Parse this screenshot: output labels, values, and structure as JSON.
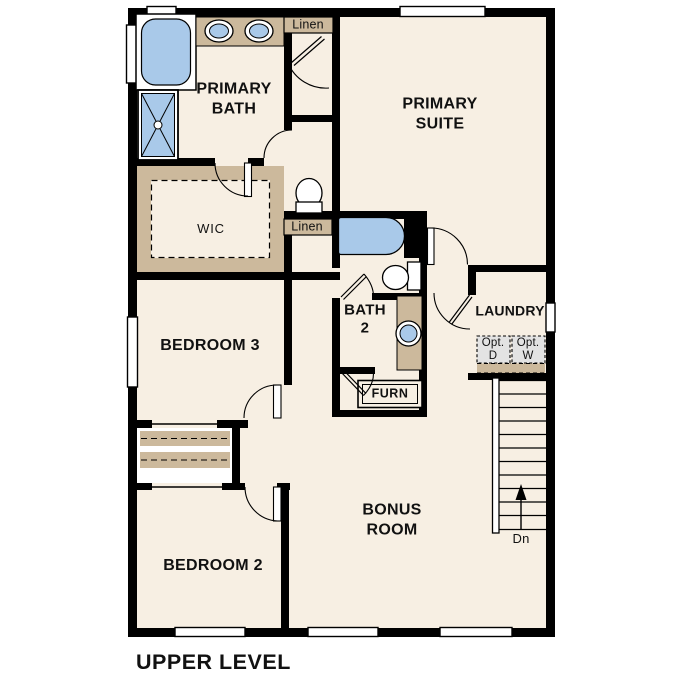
{
  "title": "UPPER LEVEL",
  "colors": {
    "wall": "#000000",
    "floor": "#f7efe3",
    "cabinet_tan": "#ccb99c",
    "fixture_blue": "#a9c9e9",
    "appliance_gray": "#e3e3e3",
    "text": "#111111",
    "background": "#ffffff"
  },
  "rooms": {
    "primary_bath": {
      "label": "PRIMARY\nBATH"
    },
    "primary_suite": {
      "label": "PRIMARY\nSUITE"
    },
    "wic": {
      "label": "WIC"
    },
    "bath_2": {
      "label": "BATH\n2"
    },
    "laundry": {
      "label": "LAUNDRY"
    },
    "bedroom_3": {
      "label": "BEDROOM 3"
    },
    "bedroom_2": {
      "label": "BEDROOM 2"
    },
    "bonus_room": {
      "label": "BONUS\nROOM"
    }
  },
  "closets": {
    "linen_upper": "Linen",
    "linen_hall": "Linen"
  },
  "fixtures": {
    "furnace": "FURN",
    "optional_dryer": "Opt.\nD",
    "optional_washer": "Opt.\nW"
  },
  "stairs": {
    "direction": "Dn"
  }
}
